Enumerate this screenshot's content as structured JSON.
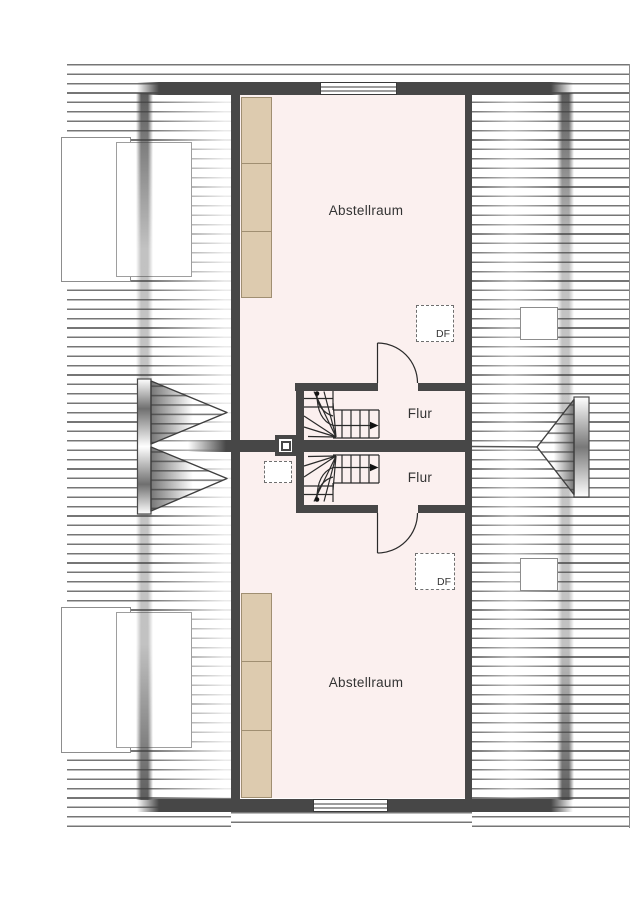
{
  "floorplan": {
    "type": "attic-floor-plan",
    "rooms": [
      {
        "label": "Abstellraum",
        "position": "top"
      },
      {
        "label": "Flur",
        "position": "upper-middle"
      },
      {
        "label": "Flur",
        "position": "lower-middle"
      },
      {
        "label": "Abstellraum",
        "position": "bottom"
      }
    ],
    "roof_windows": [
      {
        "label": "DF",
        "position": "upper"
      },
      {
        "label": "DF",
        "position": "lower"
      }
    ],
    "features": {
      "stairs": 2,
      "stair_direction": "up-arrow-right",
      "doors": 2,
      "chimney": 1,
      "facade_windows": 2,
      "dormers_left": 2,
      "gable_dormers": 3,
      "cabinets_per_room": 3
    },
    "colors": {
      "wall": "#474747",
      "room_fill": "#fbf0ef",
      "cabinet_fill": "#ddcbaf",
      "cabinet_border": "#a08f72",
      "hatch_line": "#606060",
      "background": "#ffffff",
      "text": "#333333"
    }
  }
}
